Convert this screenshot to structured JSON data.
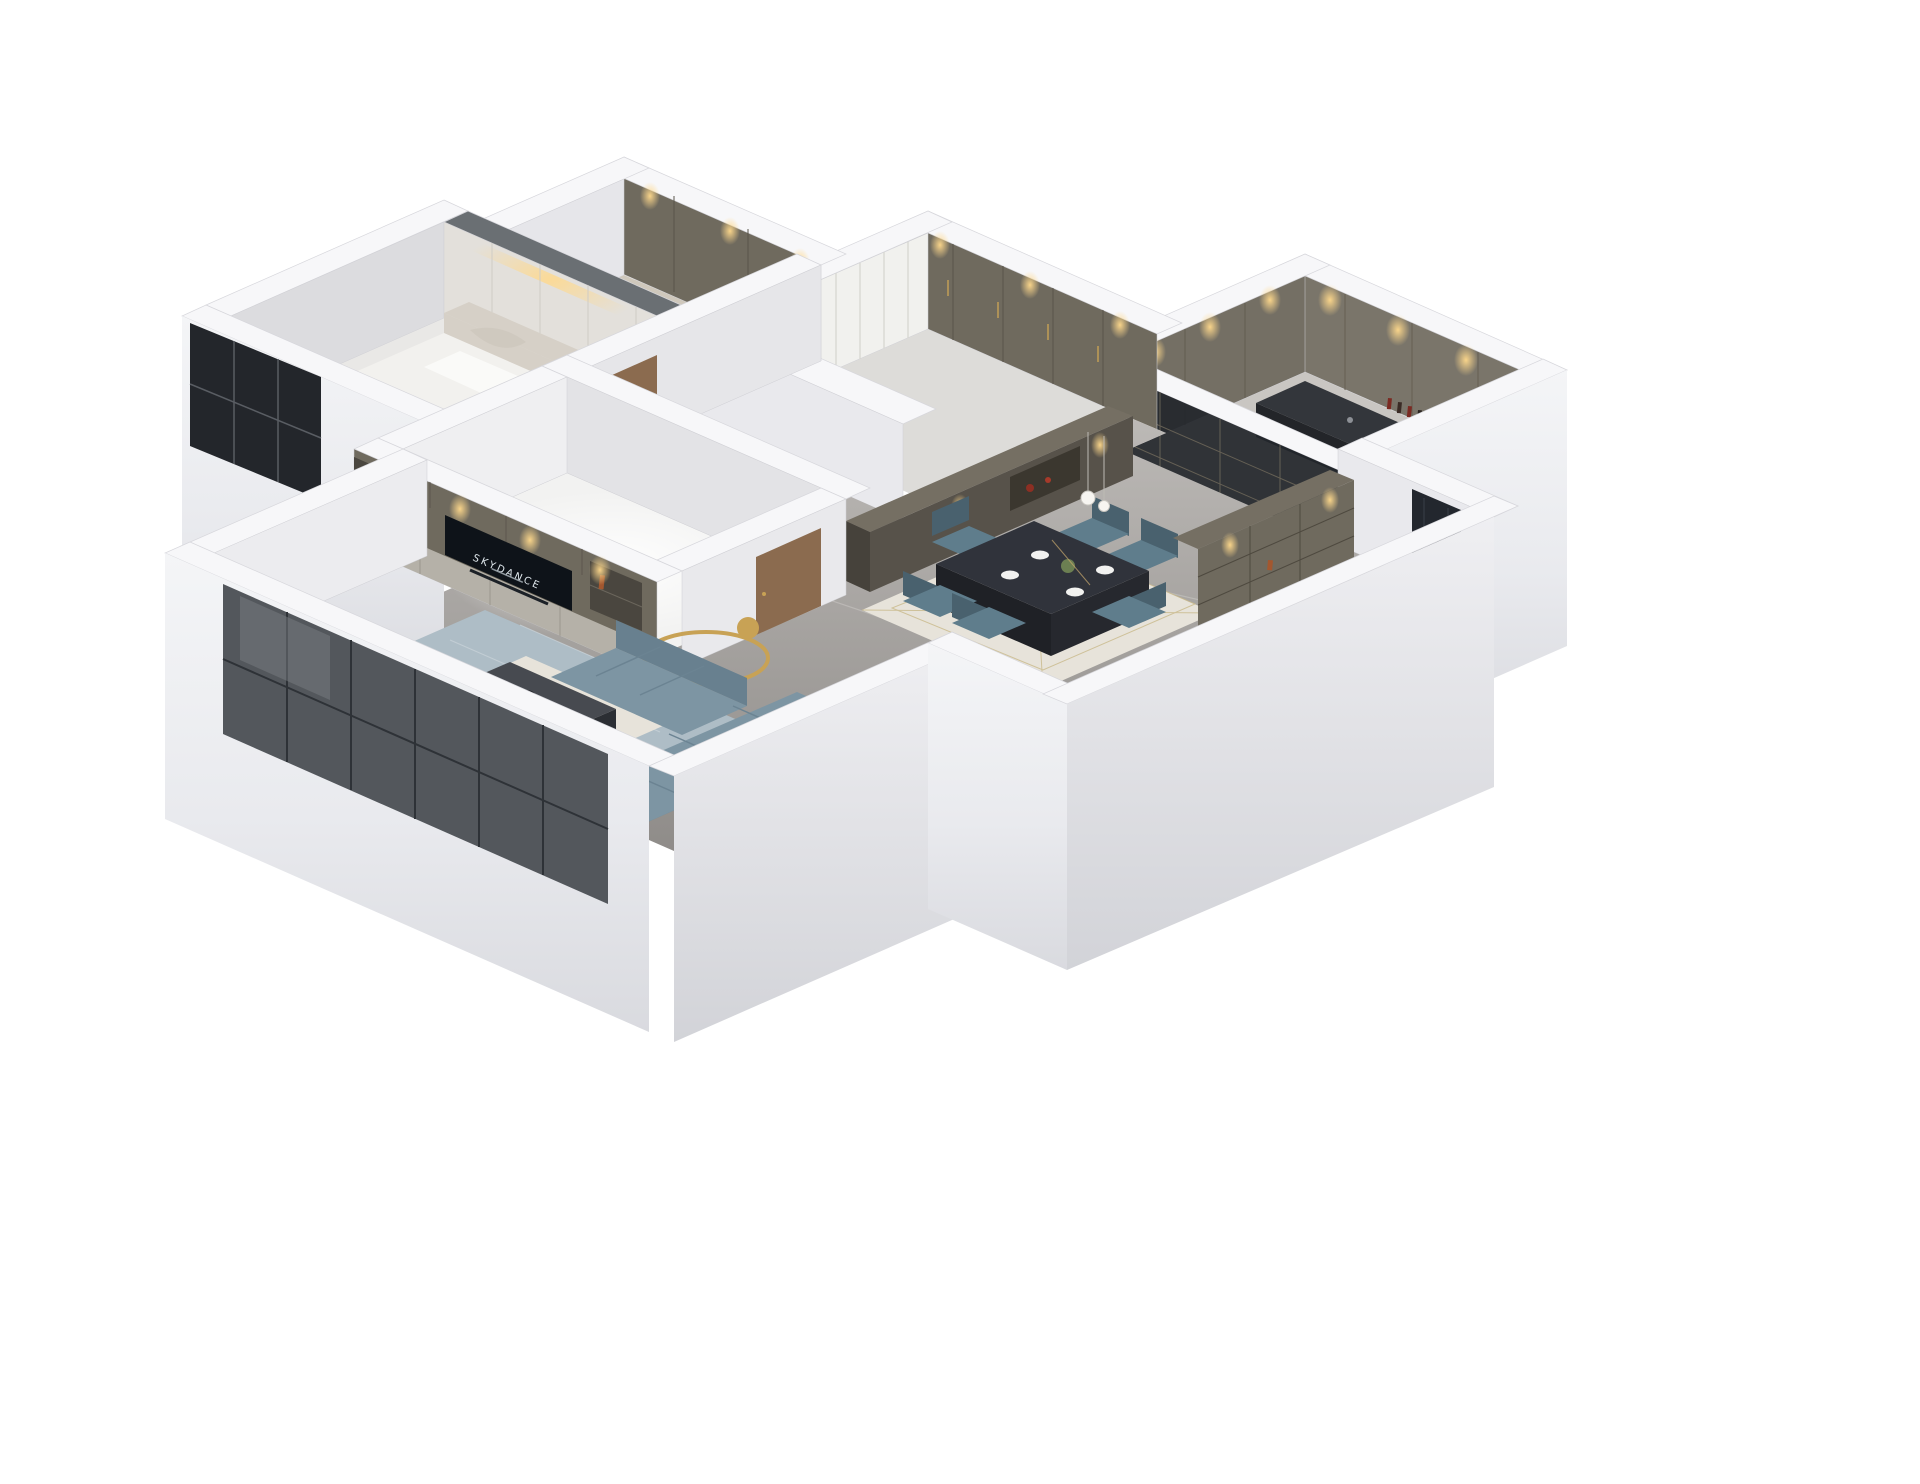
{
  "scene": {
    "kind": "isometric-3d-floorplan-render",
    "background": "#ffffff",
    "view": "cutaway dollhouse apartment, viewed from south-east above"
  },
  "tv": {
    "label": "SKYDANCE"
  },
  "rooms": [
    {
      "id": "master-bedroom",
      "desc": "bed with ornate cream headboard, nightstand, cove lighting, marble accent wall"
    },
    {
      "id": "walk-in-closet",
      "desc": "open shelving cubbies, downlights"
    },
    {
      "id": "bedroom-2",
      "desc": "sheer curtain wall, olive wardrobe with brass handles"
    },
    {
      "id": "kitchen",
      "desc": "olive cabinets, dark counter, wine shelf, glass sliding wall"
    },
    {
      "id": "hallway",
      "desc": "marble floor, walnut doors"
    },
    {
      "id": "bedroom-3",
      "desc": "bright daylit room"
    },
    {
      "id": "dining-room",
      "desc": "dark stone table, six blue chairs, ivory rug, pendant"
    },
    {
      "id": "living-room",
      "desc": "L-shaped blue sofa, marble coffee table, gold ring lamp, tan chair, patterned rug, TV media wall"
    },
    {
      "id": "entry",
      "desc": "dark paneled front door, tall display cabinet"
    }
  ],
  "colors": {
    "wallTop": "#f7f7f9",
    "wallFace": "#e9e9ed",
    "wallShade": "#dfdfe4",
    "exterior": "#eceef1",
    "marbleFloor": "#aaa7a4",
    "lightFloor": "#ecebe9",
    "cabinet": "#6f6a5e",
    "cabinetDark": "#57524a",
    "cabinetLight": "#b5b1a8",
    "slateTop": "#6a6f73",
    "sofa": "#7d95a3",
    "sofaDark": "#68808f",
    "chair": "#5f7d8c",
    "chairDark": "#49616e",
    "table": "#30333b",
    "rug": "#aebdc6",
    "rugInner": "#e7e3da",
    "tan": "#d2a878",
    "wood": "#8b6b4f",
    "gold": "#c8a255",
    "glass": "#23262b",
    "screen": "#0e1319",
    "warm": "#ffd98c",
    "bedCream": "#d6d0c7"
  }
}
